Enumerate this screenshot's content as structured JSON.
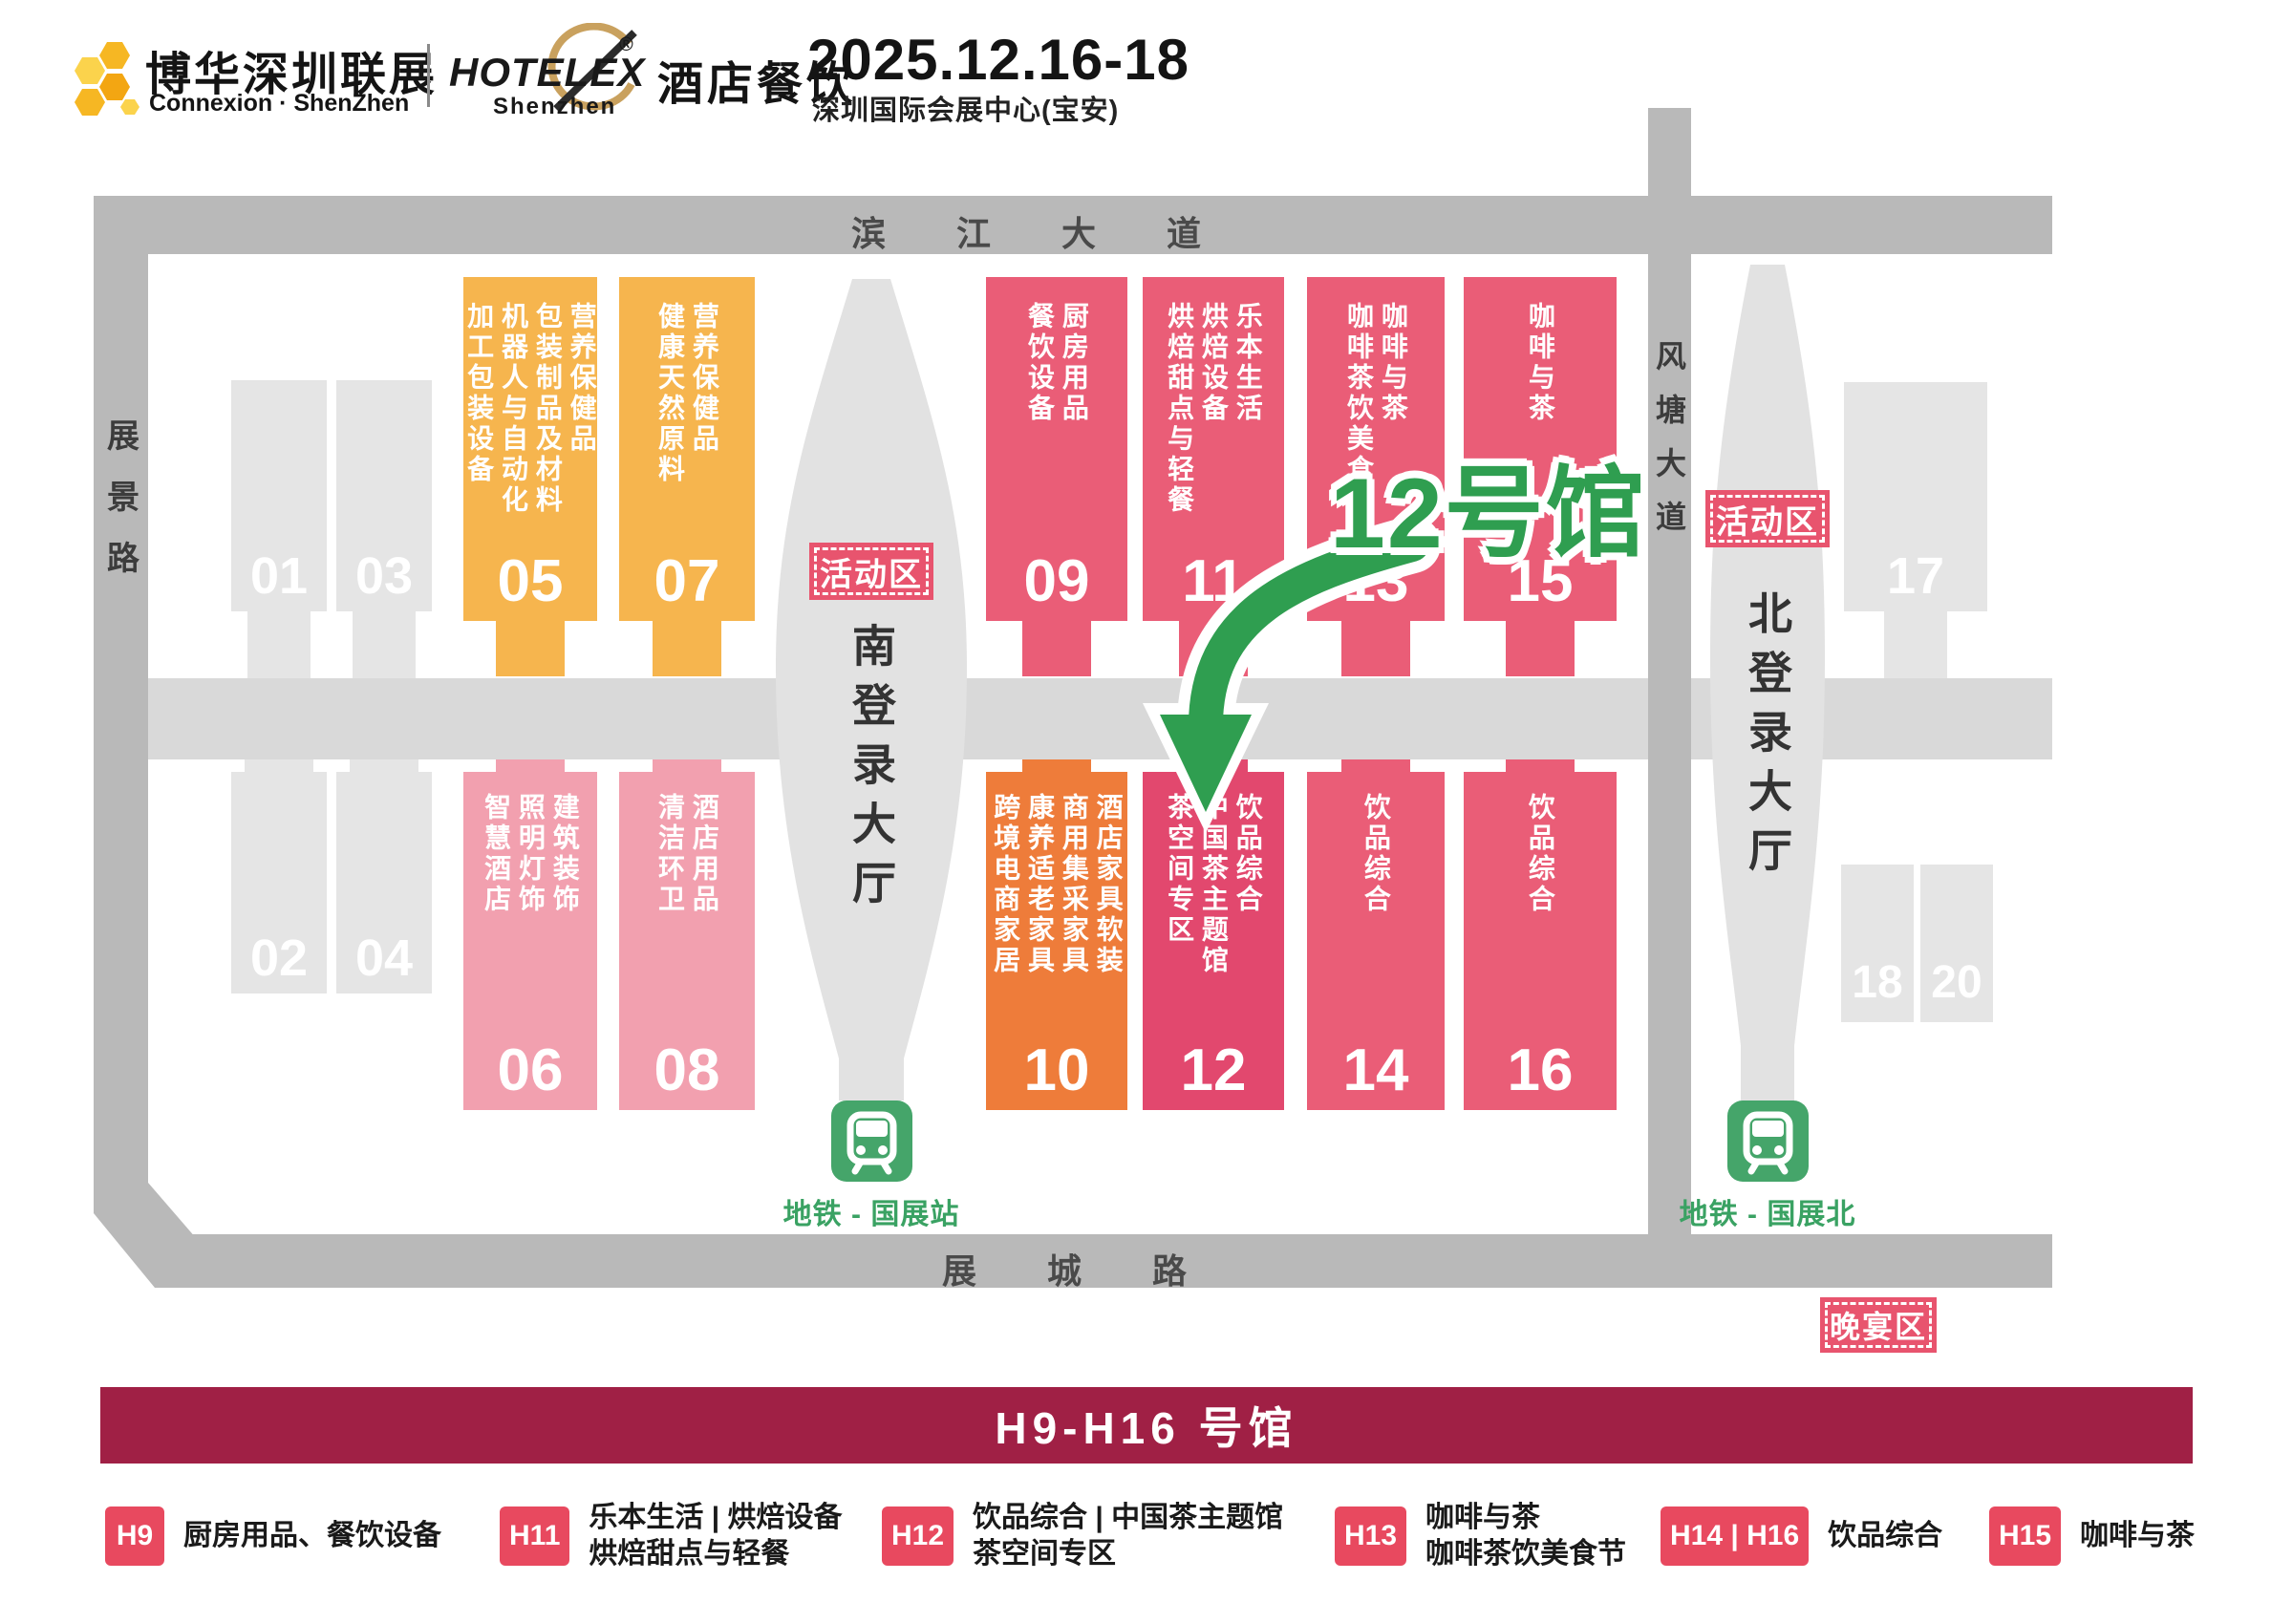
{
  "header": {
    "brand_cn": "博华深圳联展",
    "brand_en": "Connexion · ShenZhen",
    "hotelex": "HOTELEX",
    "hotelex_reg": "®",
    "hotelex_sub": "Shenzhen",
    "hotelex_cn": "酒店餐饮",
    "date": "2025.12.16-18",
    "venue": "深圳国际会展中心(宝安)"
  },
  "map": {
    "roads": {
      "top": "滨 江 大 道",
      "left": "展景路",
      "right": "风塘大道",
      "bottom": "展 城 路"
    },
    "south_lobby": "南登录大厅",
    "north_lobby": "北登录大厅",
    "activity_badge_south": "活动区",
    "activity_badge_north": "活动区",
    "banquet_badge": "晚宴区",
    "metro_south": "地铁 - 国展站",
    "metro_north": "地铁 - 国展北",
    "highlight": "12号馆",
    "halls": {
      "h01": {
        "num": "01",
        "cats": ""
      },
      "h02": {
        "num": "02",
        "cats": ""
      },
      "h03": {
        "num": "03",
        "cats": ""
      },
      "h04": {
        "num": "04",
        "cats": ""
      },
      "h05": {
        "num": "05",
        "cats": "加工包装设备\n机器人与自动化\n包装制品及材料\n营养保健品"
      },
      "h06": {
        "num": "06",
        "cats": "智慧酒店\n照明灯饰\n建筑装饰"
      },
      "h07": {
        "num": "07",
        "cats": "健康天然原料\n营养保健品"
      },
      "h08": {
        "num": "08",
        "cats": "清洁环卫\n酒店用品"
      },
      "h09": {
        "num": "09",
        "cats": "餐饮设备\n厨房用品"
      },
      "h10": {
        "num": "10",
        "cats": "跨境电商家居\n康养适老家具\n商用集采家具\n酒店家具软装"
      },
      "h11": {
        "num": "11",
        "cats": "烘焙甜点与轻餐\n烘焙设备\n乐本生活"
      },
      "h12": {
        "num": "12",
        "cats": "茶空间专区\n中国茶主题馆\n饮品综合"
      },
      "h13": {
        "num": "13",
        "cats": "咖啡茶饮美食节\n咖啡与茶"
      },
      "h14": {
        "num": "14",
        "cats": "饮品综合"
      },
      "h15": {
        "num": "15",
        "cats": "咖啡与茶"
      },
      "h16": {
        "num": "16",
        "cats": "饮品综合"
      },
      "h17": {
        "num": "17",
        "cats": ""
      },
      "h18": {
        "num": "18",
        "cats": ""
      },
      "h20": {
        "num": "20",
        "cats": ""
      }
    }
  },
  "banner": "H9-H16 号馆",
  "legend": [
    {
      "tag": "H9",
      "lines": [
        "厨房用品、餐饮设备"
      ]
    },
    {
      "tag": "H11",
      "lines": [
        "乐本生活 | 烘焙设备",
        "烘焙甜点与轻餐"
      ]
    },
    {
      "tag": "H12",
      "lines": [
        "饮品综合 | 中国茶主题馆",
        "茶空间专区"
      ]
    },
    {
      "tag": "H13",
      "lines": [
        "咖啡与茶",
        "咖啡茶饮美食节"
      ]
    },
    {
      "tag": "H14 | H16",
      "lines": [
        "饮品综合"
      ]
    },
    {
      "tag": "H15",
      "lines": [
        "咖啡与茶"
      ]
    }
  ],
  "colors": {
    "amber_hall": "#f6b54e",
    "pink_hall": "#ea5d77",
    "deep_pink_hall": "#e2486e",
    "light_pink_hall": "#f2a0af",
    "orange_hall": "#ee7c3a",
    "gray_hall": "#e5e5e5",
    "road_gray": "#b9b9b9",
    "corridor_gray": "#d9d9d9",
    "lobby_gray": "#e2e2e2",
    "highlight_green": "#2f9e50",
    "metro_green": "#45a56a",
    "badge_pink": "#e8546e",
    "legend_chip_red": "#e8495f",
    "banner_maroon": "#a02045",
    "logo_gold": "#f6b723"
  }
}
